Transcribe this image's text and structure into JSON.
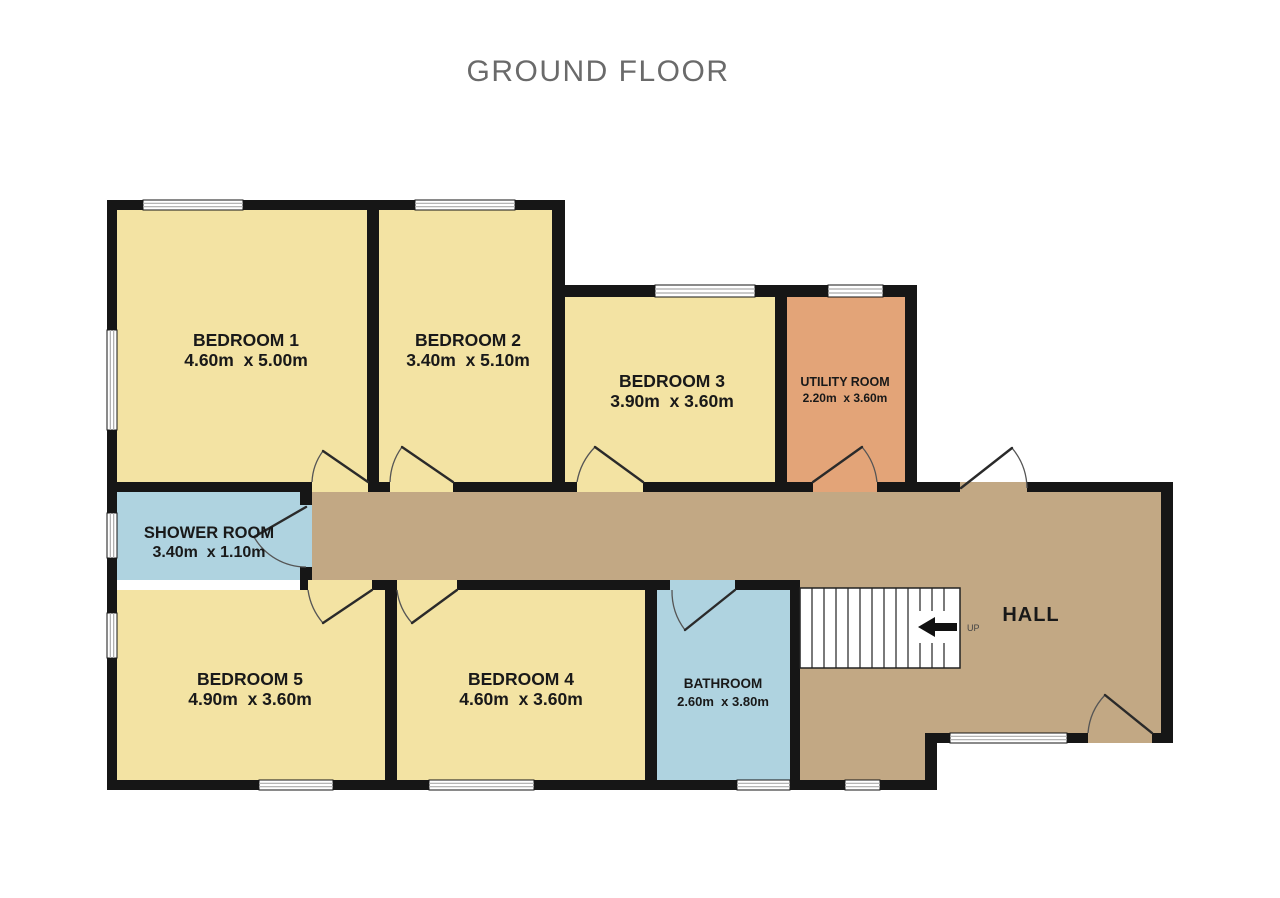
{
  "title": "GROUND FLOOR",
  "rooms": {
    "bedroom1": {
      "name": "BEDROOM 1",
      "dims": "4.60m  x 5.00m"
    },
    "bedroom2": {
      "name": "BEDROOM 2",
      "dims": "3.40m  x 5.10m"
    },
    "bedroom3": {
      "name": "BEDROOM 3",
      "dims": "3.90m  x 3.60m"
    },
    "utility": {
      "name": "UTILITY ROOM",
      "dims": "2.20m  x 3.60m"
    },
    "shower": {
      "name": "SHOWER ROOM",
      "dims": "3.40m  x 1.10m"
    },
    "bedroom5": {
      "name": "BEDROOM 5",
      "dims": "4.90m  x 3.60m"
    },
    "bedroom4": {
      "name": "BEDROOM 4",
      "dims": "4.60m  x 3.60m"
    },
    "bathroom": {
      "name": "BATHROOM",
      "dims": "2.60m  x 3.80m"
    },
    "hall": {
      "name": "HALL"
    }
  },
  "stairs": {
    "label": "UP"
  },
  "colors": {
    "bedroom": "#F3E3A3",
    "hall": "#C2A884",
    "wet": "#AFD3E0",
    "utility": "#E3A478",
    "wall": "#161616",
    "title_text": "#6A6A6A",
    "label_text": "#191919",
    "window_line": "#ABABAB",
    "door_arc": "#555555",
    "stair_line": "#222222"
  }
}
